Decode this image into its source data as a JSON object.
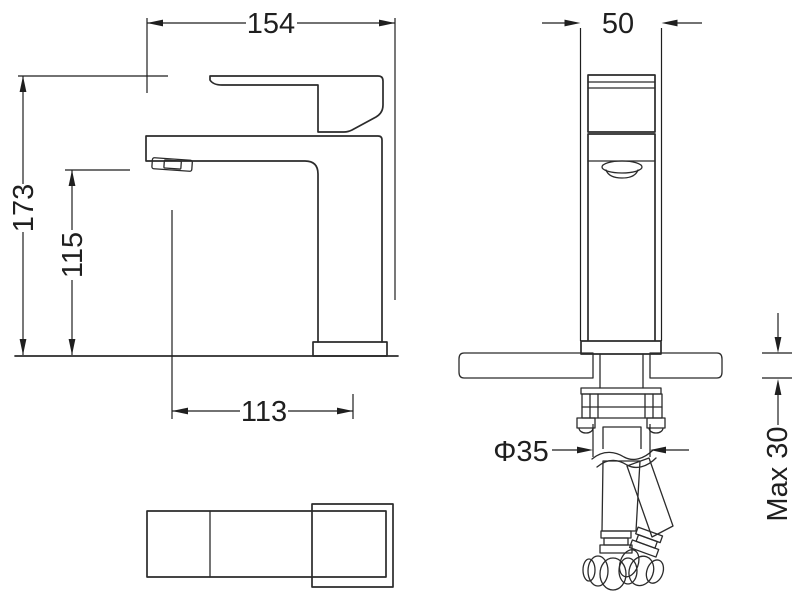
{
  "drawing": {
    "background": "#ffffff",
    "line_color": "#2b2b2b",
    "dim_color": "#1f1f1f",
    "dimensions": {
      "overall_length": "154",
      "base_width": "50",
      "overall_height": "173",
      "spout_height": "115",
      "spout_reach": "113",
      "hole_diameter": "Φ35",
      "max_mounting_thickness": "Max 30"
    }
  }
}
